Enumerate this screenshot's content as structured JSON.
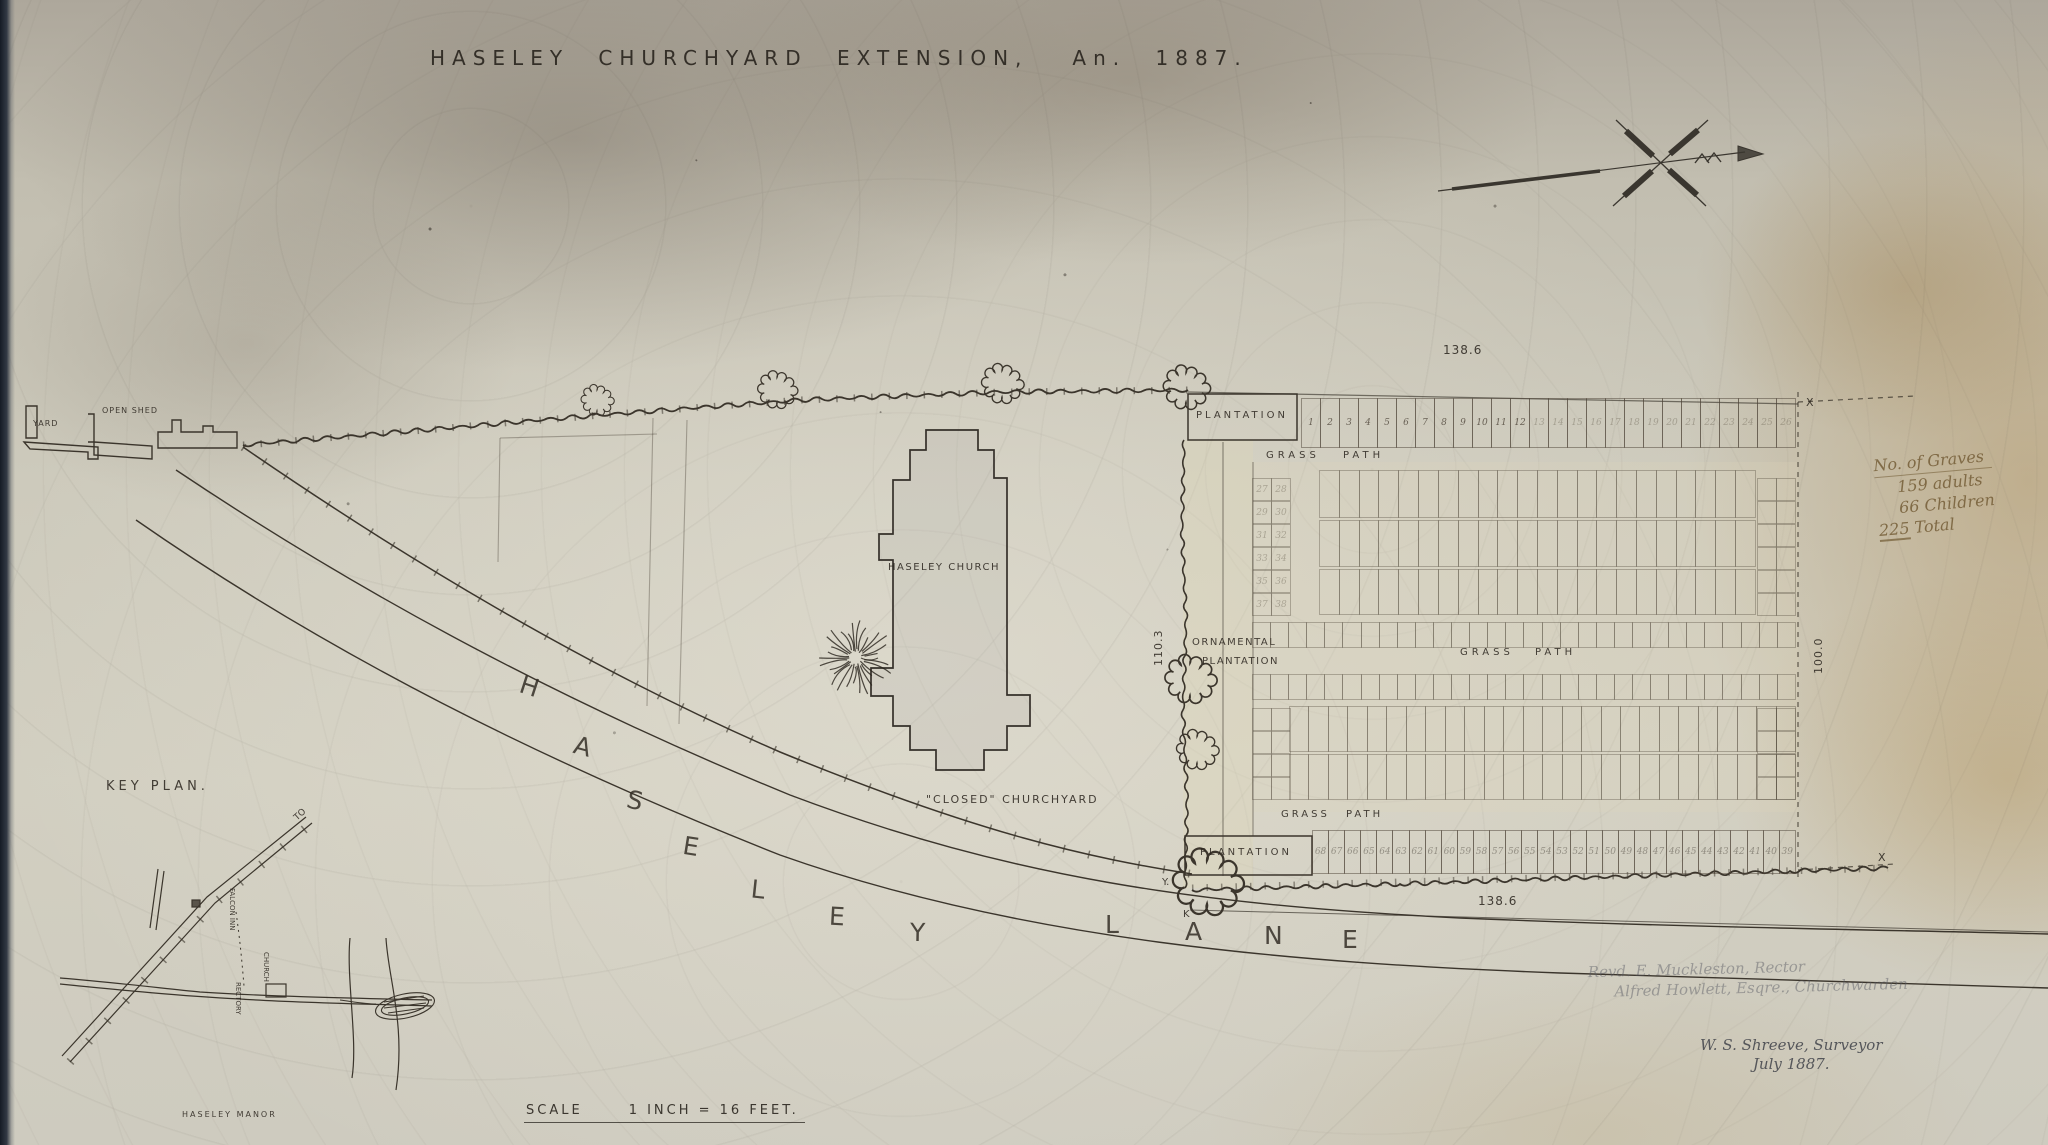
{
  "title": {
    "main": "HASELEY CHURCHYARD EXTENSION,",
    "year": "An. 1887."
  },
  "plan_labels": {
    "yard": "YARD",
    "open_shed": "OPEN SHED",
    "plantation_top": "PLANTATION",
    "plantation_bottom": "PLANTATION",
    "grass_path_top": "GRASS PATH",
    "grass_path_middle": "GRASS PATH",
    "grass_path_bottom": "GRASS PATH",
    "ornamental_line1": "ORNAMENTAL",
    "ornamental_line2": "PLANTATION",
    "church": "HASELEY CHURCH",
    "closed_churchyard": "\"CLOSED\" CHURCHYARD"
  },
  "street": {
    "name": "HASELEY LANE",
    "letters": [
      "H",
      "A",
      "S",
      "E",
      "L",
      "E",
      "Y",
      "L",
      "A",
      "N",
      "E"
    ]
  },
  "measurements": {
    "top_width": "138.6",
    "bottom_width": "138.6",
    "west_height": "110.3",
    "east_height": "100.0"
  },
  "survey_marks": {
    "top_right": "X",
    "bottom_right": "X",
    "hedge_y": "Y.",
    "hedge_k": "K"
  },
  "notes": {
    "graves": {
      "heading": "No. of Graves",
      "line1": "159 adults",
      "line2": "66 Children",
      "total_number": "225",
      "total_word": "Total"
    },
    "officials_line1": "Revd. E. Muckleston, Rector",
    "officials_line2": "Alfred Howlett, Esqre., Churchwarden",
    "surveyor_line1": "W. S. Shreeve, Surveyor",
    "surveyor_line2": "July 1887."
  },
  "key_plan": {
    "label": "KEY PLAN.",
    "to": "TO",
    "falcon_inn": "FALCON INN",
    "church": "CHURCH",
    "rectory": "RECTORY",
    "manor": "HASELEY MANOR"
  },
  "scale": {
    "word": "SCALE",
    "value": "1 INCH = 16 FEET."
  },
  "plots": {
    "top_row": [
      "1",
      "2",
      "3",
      "4",
      "5",
      "6",
      "7",
      "8",
      "9",
      "10",
      "11",
      "12",
      "13",
      "14",
      "15",
      "16",
      "17",
      "18",
      "19",
      "20",
      "21",
      "22",
      "23",
      "24",
      "25",
      "26"
    ],
    "bottom_row": [
      "68",
      "67",
      "66",
      "65",
      "64",
      "63",
      "62",
      "61",
      "60",
      "59",
      "58",
      "57",
      "56",
      "55",
      "54",
      "53",
      "52",
      "51",
      "50",
      "49",
      "48",
      "47",
      "46",
      "45",
      "44",
      "43",
      "42",
      "41",
      "40",
      "39"
    ],
    "upper_left_pairs": [
      "27",
      "28",
      "29",
      "30",
      "31",
      "32",
      "33",
      "34",
      "35",
      "36",
      "37",
      "38"
    ]
  },
  "icons": {
    "north_arrow": "north-arrow"
  },
  "colors": {
    "ink": "#36312a",
    "pencil": "#6f6a63",
    "sepia": "#76603a",
    "paper": "#cdc9bb"
  }
}
